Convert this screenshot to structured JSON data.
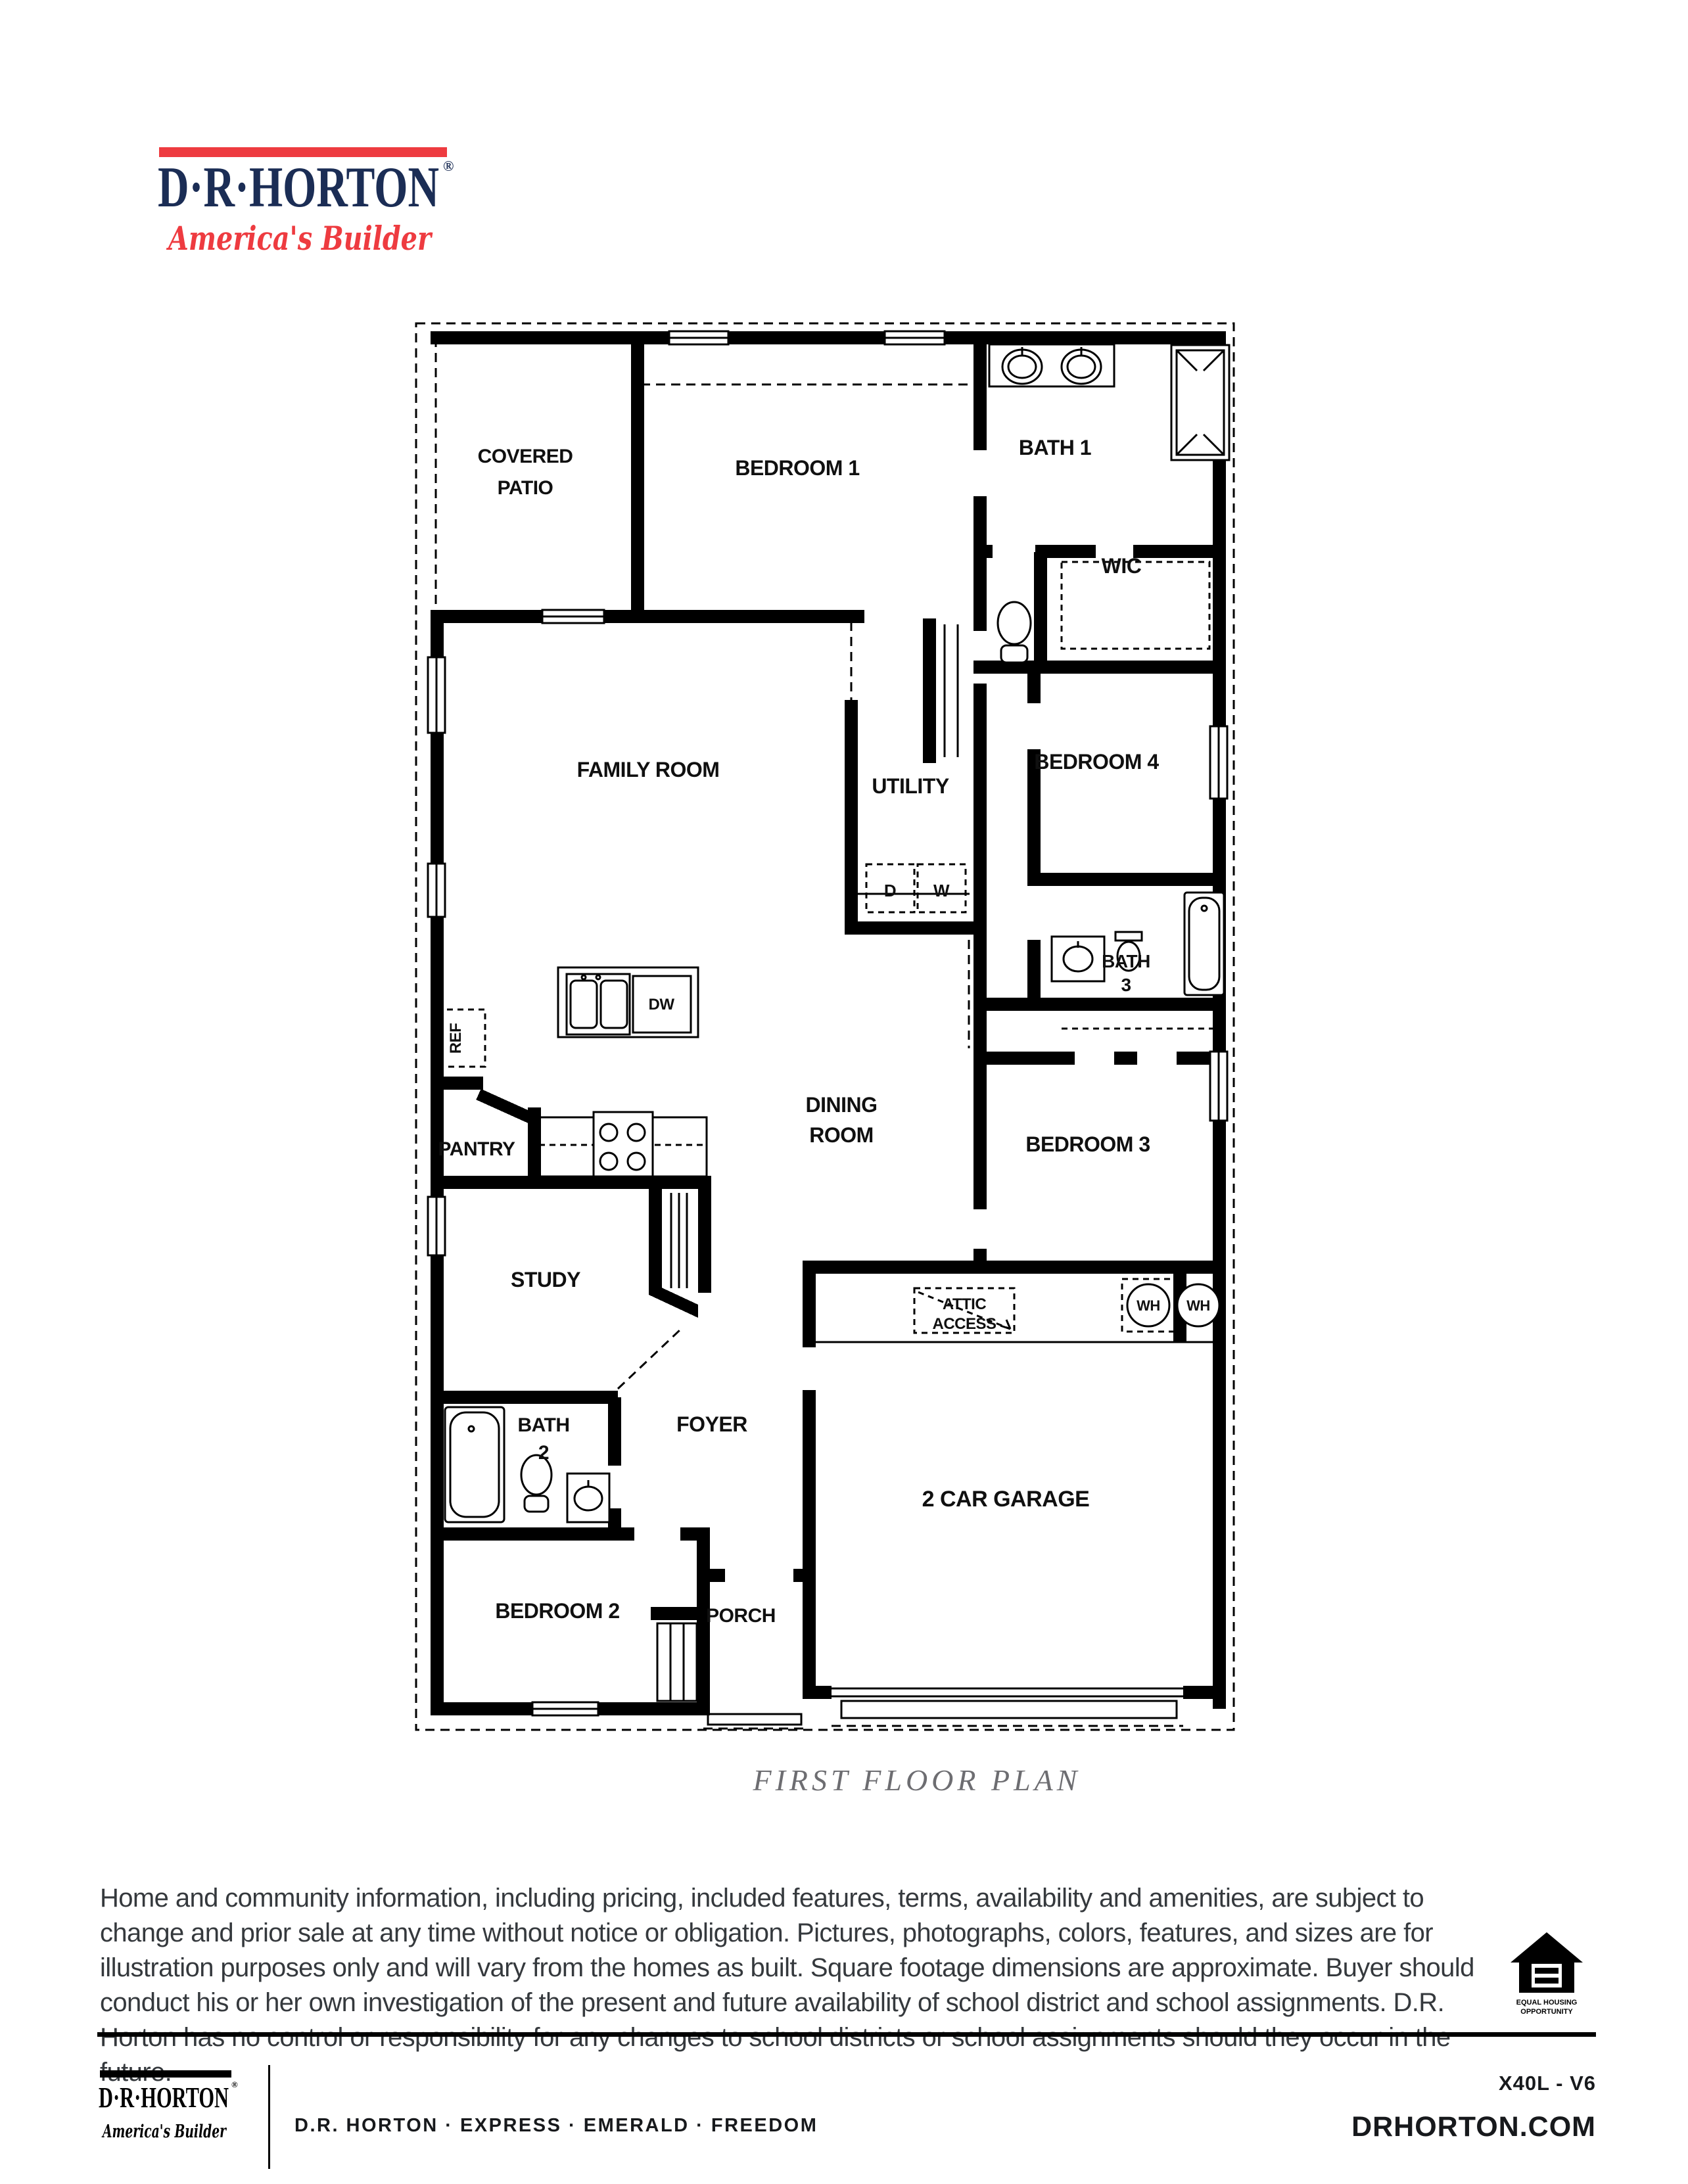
{
  "colors": {
    "brand_navy": "#1b2d55",
    "brand_red": "#ee3b40",
    "caption_gray": "#6d6d71",
    "wall_black": "#000000"
  },
  "header_logo": {
    "brand": "D·R·HORTON",
    "registered": "®",
    "tagline": "America's Builder"
  },
  "plan": {
    "caption": "FIRST FLOOR PLAN",
    "labels": {
      "covered": "COVERED",
      "patio": "PATIO",
      "bedroom1": "BEDROOM 1",
      "bath1": "BATH 1",
      "wic": "WIC",
      "family": "FAMILY ROOM",
      "utility": "UTILITY",
      "bedroom4": "BEDROOM 4",
      "bath3_line1": "BATH",
      "bath3_line2": "3",
      "dryer": "D",
      "washer": "W",
      "ref": "REF",
      "dw": "DW",
      "dining_line1": "DINING",
      "dining_line2": "ROOM",
      "pantry": "PANTRY",
      "bedroom3": "BEDROOM 3",
      "study": "STUDY",
      "attic_line1": "ATTIC",
      "attic_line2": "ACCESS",
      "wh1": "WH",
      "wh2": "WH",
      "bath2_line1": "BATH",
      "bath2_line2": "2",
      "foyer": "FOYER",
      "garage": "2 CAR GARAGE",
      "bedroom2": "BEDROOM 2",
      "porch": "PORCH"
    }
  },
  "disclaimer": "Home and community information, including pricing, included features, terms, availability and amenities, are subject to change and prior sale at any time without notice or obligation. Pictures, photographs, colors, features, and sizes are for illustration purposes only and will vary from the homes as built.  Square footage dimensions are approximate. Buyer should conduct his or her own investigation of the present and future availability of school district and school assignments.  D.R. Horton has no control or responsibility for any changes to school districts or school assignments should they occur in the future.",
  "eho": {
    "line1": "EQUAL HOUSING",
    "line2": "OPPORTUNITY"
  },
  "footer": {
    "logo_brand": "D·R·HORTON",
    "logo_registered": "®",
    "logo_tagline": "America's Builder",
    "tagline": "D.R. HORTON · EXPRESS · EMERALD · FREEDOM",
    "plan_code": "X40L - V6",
    "website": "DRHORTON.COM"
  }
}
